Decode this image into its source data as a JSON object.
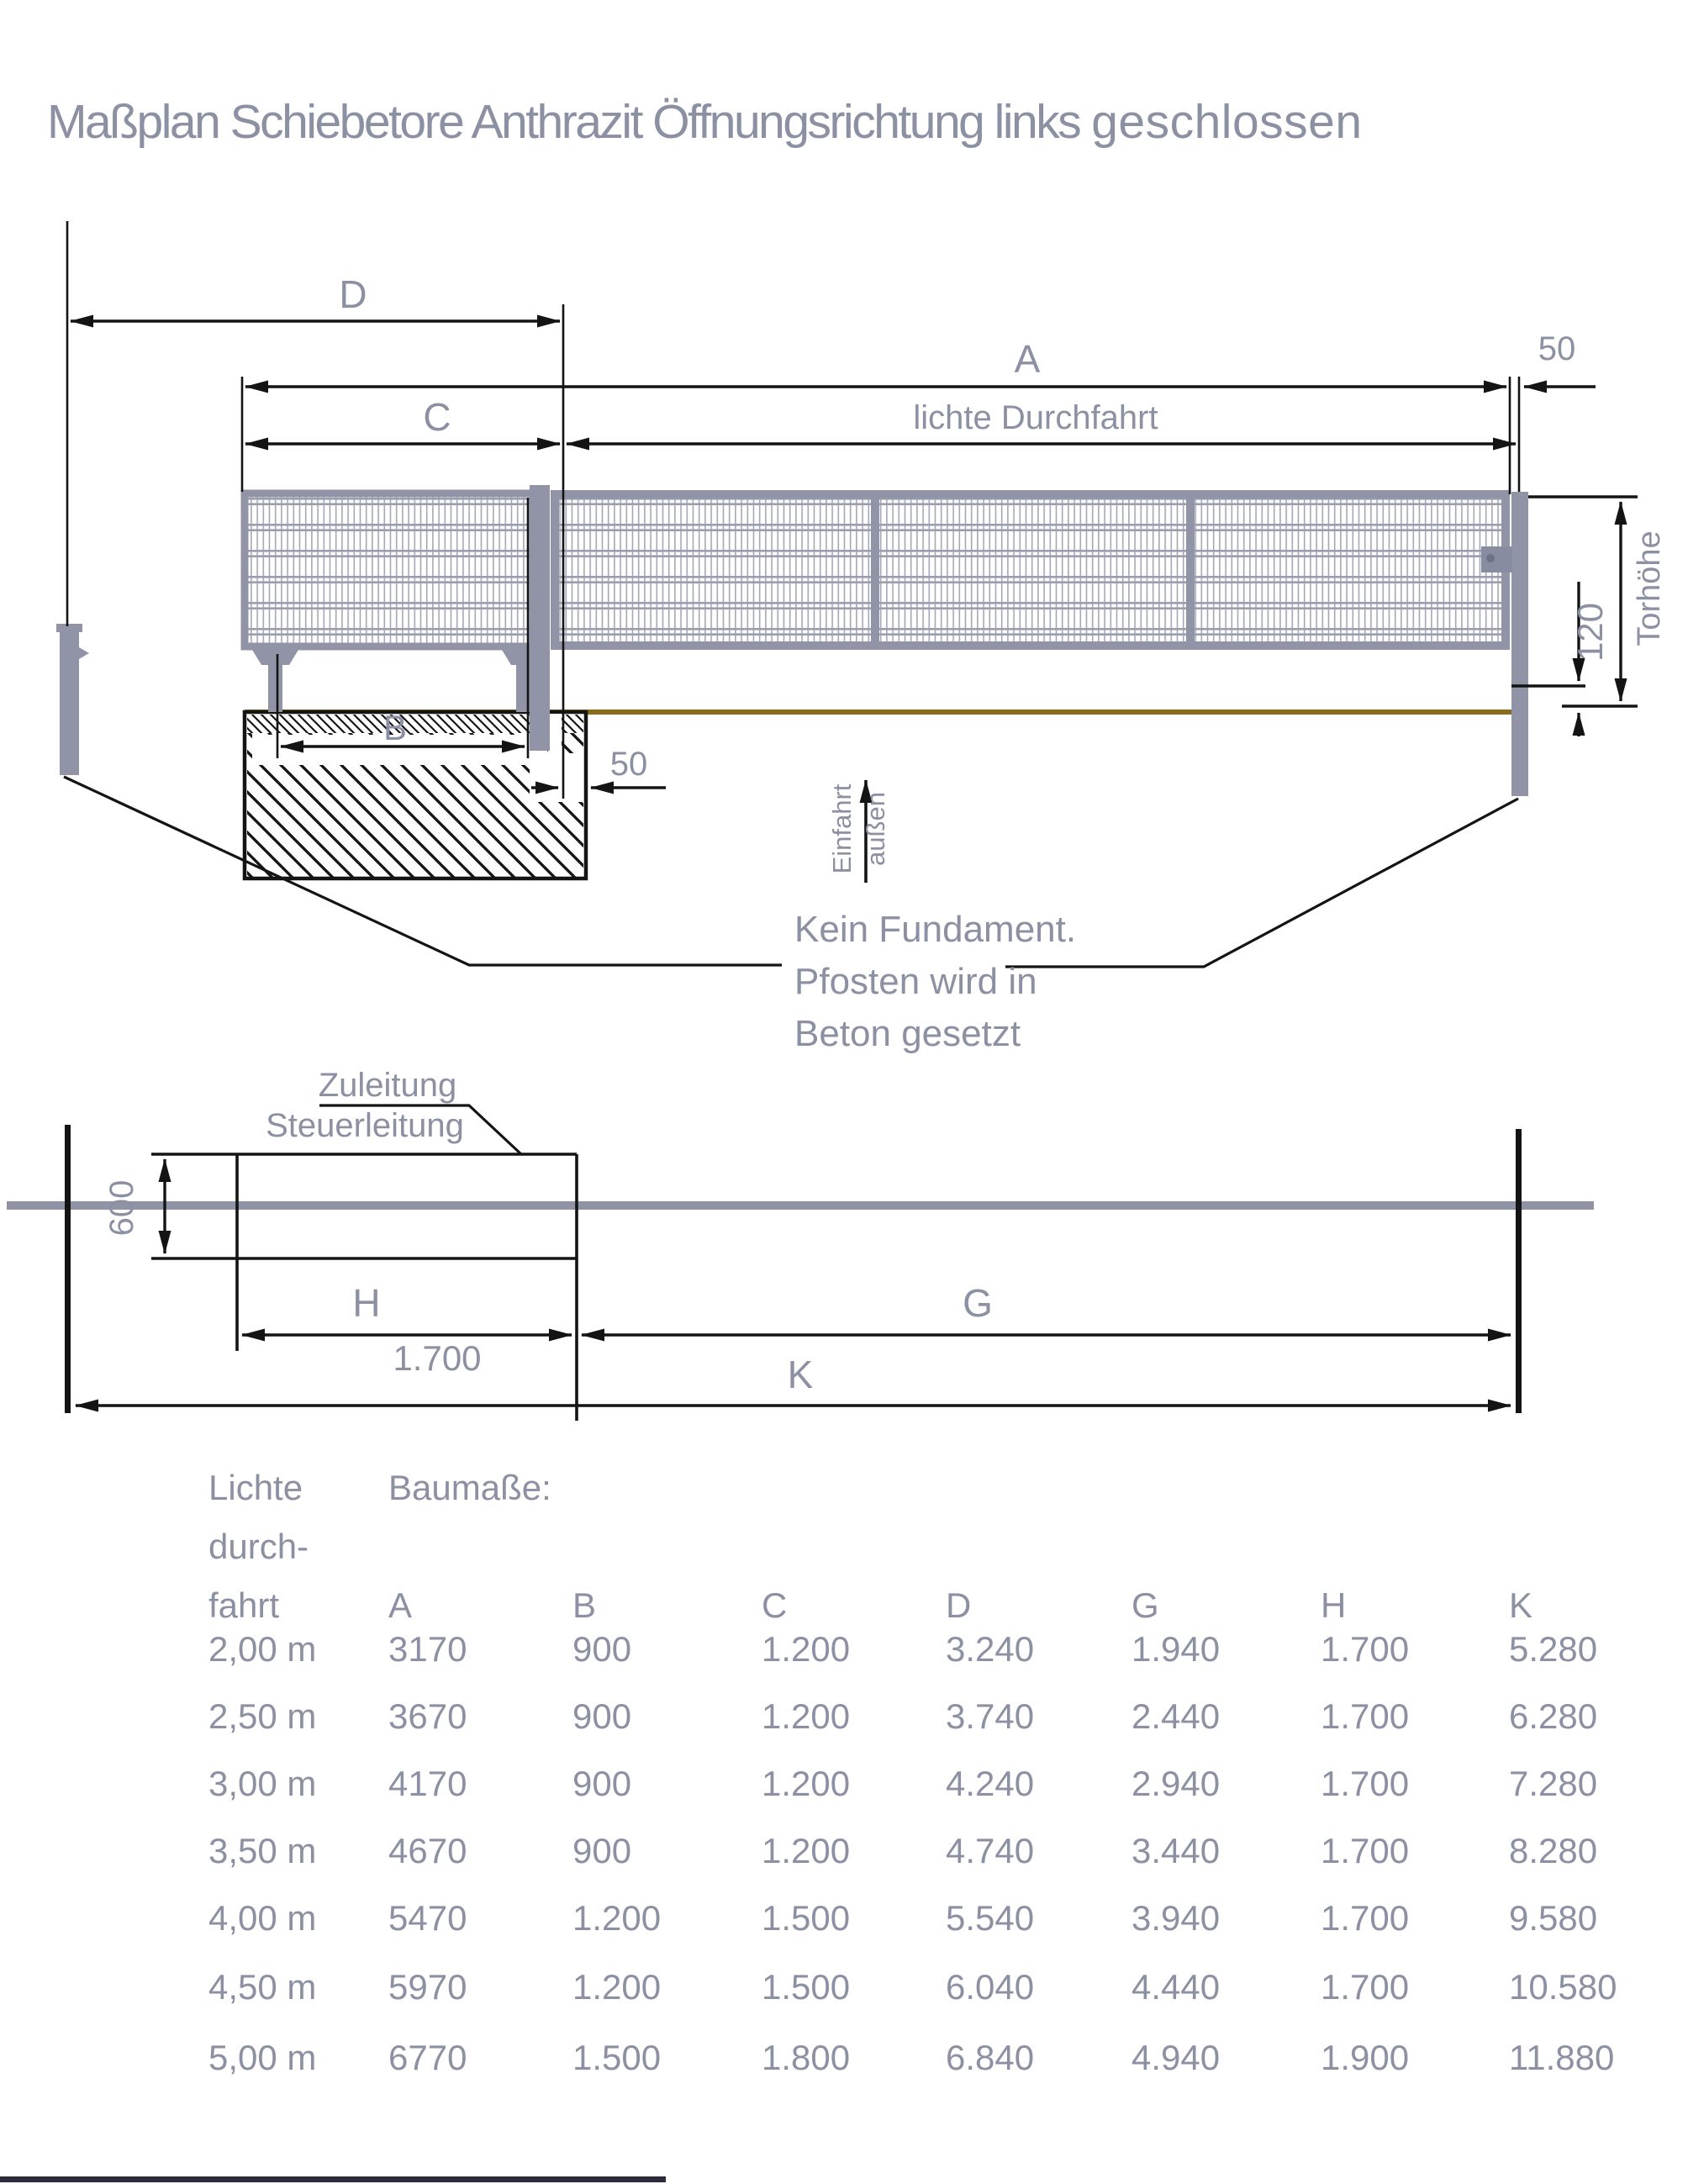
{
  "title": {
    "main": "Maßplan Schiebetore Anthrazit Öffnungsrichtung links",
    "emphasis": "geschlossen"
  },
  "elevation": {
    "dim_d": "D",
    "dim_a": "A",
    "dim_c": "C",
    "clear_passage": "lichte Durchfahrt",
    "post_gap": "50",
    "dim_b": "B",
    "foundation_gap": "50",
    "ground_clearance": "120",
    "gate_height_label": "Torhöhe",
    "drive_in": "Einfahrt",
    "outside": "außen",
    "note": {
      "line1": "Kein Fundament.",
      "line2": "Pfosten wird in",
      "line3": "Beton gesetzt"
    }
  },
  "plan": {
    "supply_line": "Zuleitung",
    "control_line": "Steuerleitung",
    "dim_600": "600",
    "dim_h": "H",
    "dim_h_value": "1.700",
    "dim_g": "G",
    "dim_k": "K"
  },
  "table": {
    "col1_lines": [
      "Lichte",
      "durch-",
      "fahrt"
    ],
    "dims_header": "Baumaße:",
    "columns": [
      "A",
      "B",
      "C",
      "D",
      "G",
      "H",
      "K"
    ],
    "rows": [
      {
        "size": "2,00 m",
        "values": [
          "3170",
          "900",
          "1.200",
          "3.240",
          "1.940",
          "1.700",
          "5.280"
        ]
      },
      {
        "size": "2,50 m",
        "values": [
          "3670",
          "900",
          "1.200",
          "3.740",
          "2.440",
          "1.700",
          "6.280"
        ]
      },
      {
        "size": "3,00 m",
        "values": [
          "4170",
          "900",
          "1.200",
          "4.240",
          "2.940",
          "1.700",
          "7.280"
        ]
      },
      {
        "size": "3,50 m",
        "values": [
          "4670",
          "900",
          "1.200",
          "4.740",
          "3.440",
          "1.700",
          "8.280"
        ]
      },
      {
        "size": "4,00 m",
        "values": [
          "5470",
          "1.200",
          "1.500",
          "5.540",
          "3.940",
          "1.700",
          "9.580"
        ]
      },
      {
        "size": "4,50 m",
        "values": [
          "5970",
          "1.200",
          "1.500",
          "6.040",
          "4.440",
          "1.700",
          "10.580"
        ]
      },
      {
        "size": "5,00 m",
        "values": [
          "6770",
          "1.500",
          "1.800",
          "6.840",
          "4.940",
          "1.900",
          "11.880"
        ]
      }
    ]
  },
  "colors": {
    "text": "#8b90a2",
    "structure": "#9094a6",
    "mesh": "#a4a8b6",
    "ground": "#8a6a1c",
    "line": "#141414"
  }
}
